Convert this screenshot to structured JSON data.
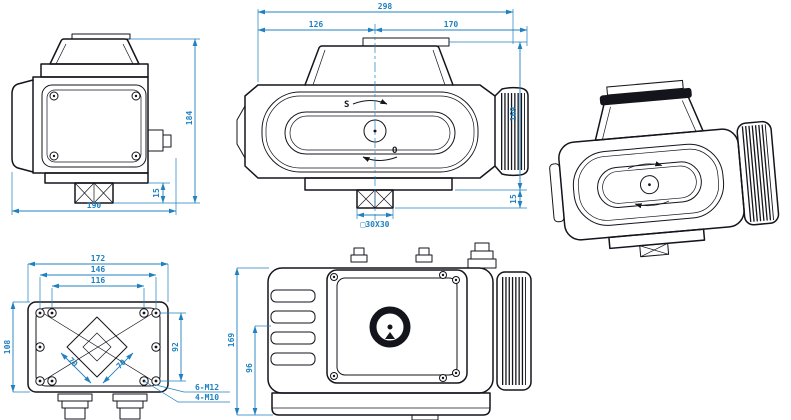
{
  "colors": {
    "dimension_lines": "#2080c0",
    "drawing_lines": "#14141c",
    "background": "#ffffff"
  },
  "views": {
    "side": {
      "dim_width": "190",
      "dim_height": "184",
      "dim_bracket": "15"
    },
    "front": {
      "dim_total": "298",
      "dim_left": "126",
      "dim_right": "170",
      "dim_height": "169",
      "dim_bracket": "15",
      "dim_square": "□30X30",
      "marker_s": "S",
      "marker_o": "O"
    },
    "bottom": {
      "dim_w1": "172",
      "dim_w2": "146",
      "dim_w3": "116",
      "dim_h1": "108",
      "dim_h2": "92",
      "dim_sq1": "70",
      "dim_sq2": "70",
      "callout1": "6-M12",
      "callout2": "4-M10"
    },
    "side2": {
      "dim_height": "169",
      "dim_lower": "96"
    }
  }
}
